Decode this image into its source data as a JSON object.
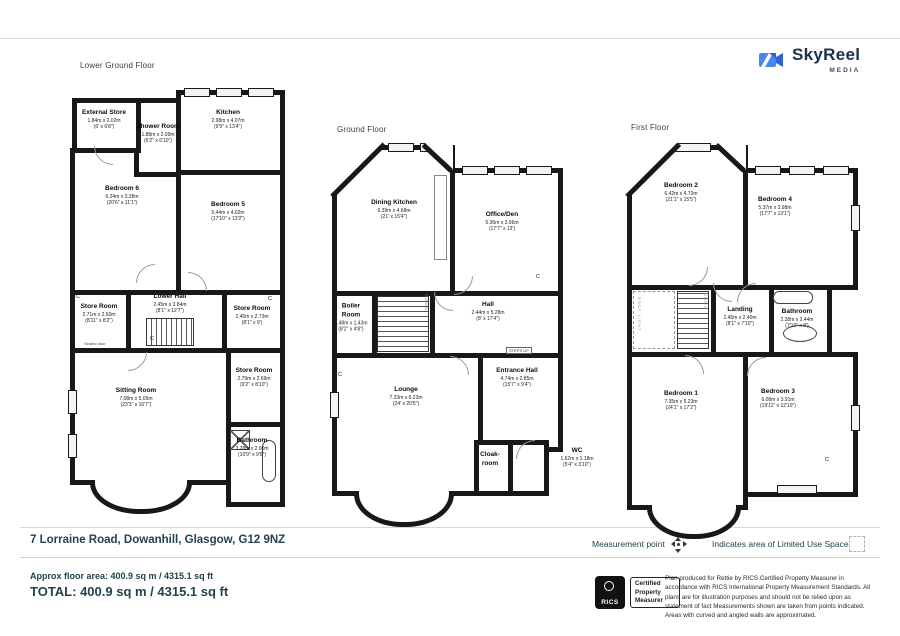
{
  "logo": {
    "brand": "SkyReel",
    "sub": "MEDIA"
  },
  "floors": [
    {
      "title": "Lower Ground Floor",
      "rooms": [
        {
          "name": "External Store",
          "metric": "1.84m x 2.02m",
          "imperial": "(6' x 6'8\")"
        },
        {
          "name": "Shower Room",
          "metric": "1.88m x 2.09m",
          "imperial": "(6'2\" x 6'10\")"
        },
        {
          "name": "Kitchen",
          "metric": "2.98m x 4.07m",
          "imperial": "(9'9\" x 13'4\")"
        },
        {
          "name": "Bedroom 6",
          "metric": "6.24m x 3.38m",
          "imperial": "(20'6\" x 11'1\")"
        },
        {
          "name": "Bedroom 5",
          "metric": "5.44m x 4.02m",
          "imperial": "(17'10\" x 13'2\")"
        },
        {
          "name": "Lower Hall",
          "metric": "2.45m x 3.84m",
          "imperial": "(8'1\" x 12'7\")"
        },
        {
          "name": "Store Room",
          "metric": "2.71m x 2.50m",
          "imperial": "(8'11\" x 8'2\")"
        },
        {
          "name": "Store Room",
          "metric": "2.45m x 2.73m",
          "imperial": "(8'1\" x 9')"
        },
        {
          "name": "Store Room",
          "metric": "2.79m x 2.69m",
          "imperial": "(9'2\" x 8'10\")"
        },
        {
          "name": "Sitting Room",
          "metric": "7.08m x 5.05m",
          "imperial": "(23'3\" x 16'7\")"
        },
        {
          "name": "Bathroom",
          "metric": "3.28m x 2.90m",
          "imperial": "(10'9\" x 9'6\")"
        }
      ]
    },
    {
      "title": "Ground Floor",
      "rooms": [
        {
          "name": "Dining Kitchen",
          "metric": "6.39m x 4.68m",
          "imperial": "(21' x 15'4\")"
        },
        {
          "name": "Office/Den",
          "metric": "5.36m x 3.96m",
          "imperial": "(17'7\" x 13')"
        },
        {
          "name": "Boiler Room",
          "metric": "2.48m x 1.43m",
          "imperial": "(8'2\" x 4'8\")"
        },
        {
          "name": "Hall",
          "metric": "2.44m x 5.28m",
          "imperial": "(8' x 17'4\")"
        },
        {
          "name": "Lounge",
          "metric": "7.33m x 6.23m",
          "imperial": "(24' x 20'5\")"
        },
        {
          "name": "Entrance Hall",
          "metric": "4.74m x 2.85m",
          "imperial": "(15'7\" x 9'4\")"
        },
        {
          "name": "Cloak- room",
          "metric": "",
          "imperial": ""
        },
        {
          "name": "WC",
          "metric": "1.62m x 1.18m",
          "imperial": "(5'4\" x 3'10\")"
        }
      ]
    },
    {
      "title": "First Floor",
      "rooms": [
        {
          "name": "Bedroom 2",
          "metric": "6.42m x 4.70m",
          "imperial": "(21'1\" x 15'5\")"
        },
        {
          "name": "Bedroom 4",
          "metric": "5.37m x 3.98m",
          "imperial": "(17'7\" x 13'1\")"
        },
        {
          "name": "Landing",
          "metric": "2.45m x 2.40m",
          "imperial": "(8'1\" x 7'10\")"
        },
        {
          "name": "Bathroom",
          "metric": "2.38m x 2.44m",
          "imperial": "(7'10\" x 8')"
        },
        {
          "name": "Bedroom 1",
          "metric": "7.35m x 5.23m",
          "imperial": "(24'1\" x 17'2\")"
        },
        {
          "name": "Bedroom 3",
          "metric": "6.08m x 3.91m",
          "imperial": "(19'11\" x 12'10\")"
        }
      ]
    }
  ],
  "annotations": {
    "sealed_door": "Sealed door",
    "steps_up": "STEPS UP",
    "roof_light": "ROOF LIGHT",
    "down": "DOWN",
    "cupboard": "C"
  },
  "address": "7 Lorraine Road, Dowanhill, Glasgow, G12 9NZ",
  "legend": {
    "measurement_point": "Measurement point",
    "limited_use": "Indicates area of  Limited Use Space"
  },
  "footer": {
    "approx_area": "Approx floor area: 400.9 sq m / 4315.1 sq ft",
    "total": "TOTAL: 400.9 sq m / 4315.1 sq ft",
    "rics_name": "RICS",
    "rics_certified": "Certified Property Measurer",
    "disclaimer": "Plan produced for Rettie by RICS Certified Property Measurer in accordance with RICS International Property Measurement Standards. All plans are for illustration purposes and should not be relied upon as statement of fact Measurements shown are taken from points indicated. Areas with curved and angled walls are approximated."
  },
  "colors": {
    "accent_blue": "#4a86f0",
    "text_teal": "#24434d",
    "wall": "#181818"
  }
}
